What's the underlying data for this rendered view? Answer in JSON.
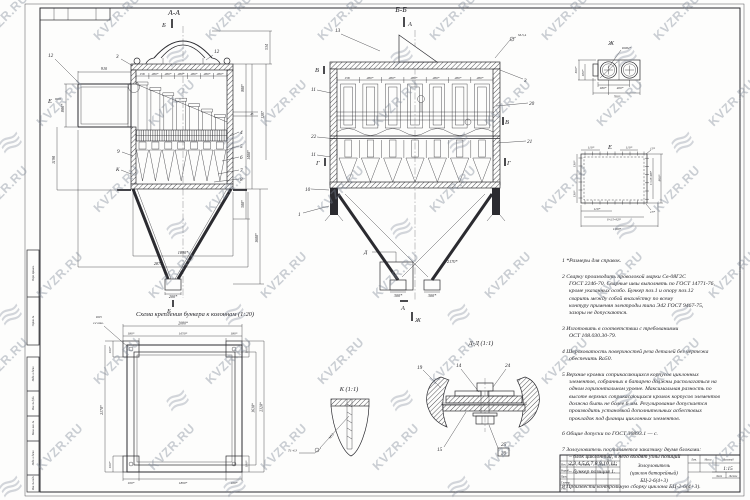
{
  "watermark": {
    "text": "KVZR.RU"
  },
  "margin": {
    "labels": [
      "Перв. примен.",
      "Справ. №",
      "Подп. и дата",
      "Инв. № дубл.",
      "Взам. инв. №",
      "Подп. и дата",
      "Инв. № подл."
    ]
  },
  "views": {
    "aa": {
      "title": "А-А",
      "marker_top": "Б",
      "marker_bottom": "Б",
      "marker_inlet": "Е",
      "marker_k": "К",
      "parts": {
        "p12_left": "12",
        "p12_cap": "12",
        "p3": "3",
        "p9": "9",
        "p4": "4",
        "p5": "5",
        "p6": "6",
        "p7": "7",
        "p8": "8"
      },
      "dims": {
        "inlet_width": "910",
        "inlet_height": "800*",
        "left_height": "1190",
        "bay_first": "158",
        "bay": "280*",
        "cap_height": "534",
        "right_800": "800*",
        "right_45": "45",
        "right_1287": "1287",
        "right_1400": "1400*",
        "right_500": "500*",
        "right_1600": "1600*",
        "bottom_1890": "1890*",
        "bottom_2875": "2875",
        "outlet_200": "200*"
      }
    },
    "bb": {
      "title": "Б-Б",
      "marker_a_top": "А",
      "marker_a_bottom": "А",
      "marker_zh": "Ж",
      "marker_d": "Д",
      "marker_v_left": "В",
      "marker_v_right": "В",
      "marker_g_left": "Г",
      "marker_g_right": "Г",
      "weld_note": "М-5,4",
      "parts": {
        "p13": "13",
        "p11_top": "11",
        "p22": "22",
        "p11_mid": "11",
        "p10": "10",
        "p1": "1",
        "p3": "3",
        "p20": "20",
        "p21": "21"
      },
      "dims": {
        "bay_first": "158",
        "bay": "280*",
        "outlet_left": "300*",
        "outlet_right": "300*",
        "width_2170": "2170*"
      }
    },
    "zh": {
      "title": "Ж",
      "dia": "Ø282*",
      "dims": {
        "h300": "300*",
        "h180": "180*",
        "b180": "180*",
        "b400": "400*",
        "b760": "760*"
      }
    },
    "e": {
      "title": "Е",
      "dims": {
        "t110a": "110*",
        "t110b": "110*",
        "t13": "13*",
        "l130a": "130*",
        "l130b": "130*",
        "r5x120": "5×120=600*",
        "r800": "800*",
        "b110": "110*",
        "b8x115": "8×115=920*",
        "b13": "13*",
        "b1180": "1180*"
      }
    },
    "plan": {
      "caption": "Схема крепления бункера к колоннам (1:20)",
      "hole_dia": "Ø25",
      "hole_count": "12 отв.",
      "dims": {
        "t2080": "2080*",
        "t1650": "1650*",
        "t180l": "180*",
        "t180r": "180*",
        "l100t": "100*",
        "l2170": "2170*",
        "l100b": "100*",
        "b100l": "100*",
        "b1890": "1890*",
        "b100r": "100*",
        "r180t": "180*",
        "r1630": "1630*",
        "r2320": "2320*",
        "r180b": "180*"
      }
    },
    "k": {
      "caption": "К (1:1)",
      "stud_label": "М12",
      "weld_flag": "Т1-4,3"
    },
    "dd": {
      "caption": "Д-Д (1:1)",
      "parts": {
        "p19": "19",
        "p14": "14",
        "p24": "24",
        "p15": "15",
        "p25": "25",
        "p26": "26"
      }
    }
  },
  "notes": [
    "1 *Размеры для справок.",
    "2 Сварку производить проволокой марки Св-08Г2С\nГОСТ 2246-70. Сварные швы выполнять по ГОСТ 14771-76,\nкроме указанных особо. Бункер поз.1 и опору поз.12\nсварить между собой внахлёстку по всему\nконтуру применяя электроды типа Э42 ГОСТ 9467-75,\nзазоры не допускаются.",
    "3 Изготовить в соответствии с требованиями\nОСТ 108.030.30-79.",
    "4 Шероховатость поверхностей реза деталей без чертежа\nобеспечить Ra50.",
    "5 Верхние кромки соприкасающихся корпусов циклонных\nэлементов, собранных в батарею должны располагаться на\nодном горизонтальном уровне. Максимальная разность по\nвысоте верхних соприкасающихся кромок корпусов элементов\nдолжна быть не более 6 мм. Регулирование допускается\nпроизводить установкой дополнительных асбестовых\nпрокладок под фланцы циклонных элементов.",
    "6 Общие допуски по ГОСТ 30893.1 — с.",
    "7 Золоуловитель поставляется заказчику двумя блоками:\n– блок циклонный, в него входят узлы позиций\n2,3,4,5,6,7,8,9,10,11;\n– бункер позиция 1.",
    "8 Произвести контрольную сборку циклона БЦ-2-6(4+3)."
  ],
  "title_block": {
    "name_l1": "Золоуловитель",
    "name_l2": "(циклон батарейный)",
    "name_l3": "БЦ-2-6(4+3)",
    "scale_value": "1:15",
    "hdr_izm": "Изм.",
    "hdr_list": "Лист",
    "hdr_doc": "№ докум.",
    "hdr_podp": "Подп.",
    "hdr_data": "Дата",
    "r1": "Разраб.",
    "r2": "Пров.",
    "r3": "Т.контр.",
    "r4": "Н.контр.",
    "r5": "Утв.",
    "lit": "Лит.",
    "massa": "Масса",
    "masshtab": "Масштаб",
    "list": "Лист",
    "listov": "Листов"
  }
}
